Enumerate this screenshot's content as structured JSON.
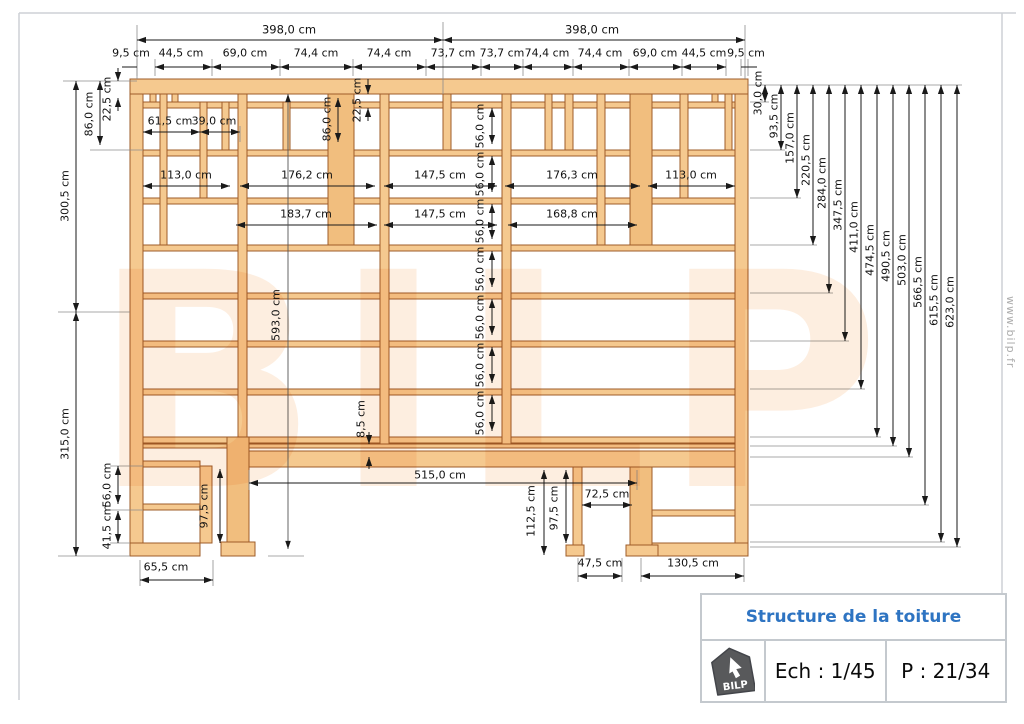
{
  "title_block": {
    "title": "Structure de la toiture",
    "logo_text": "BILP",
    "scale": "Ech : 1/45",
    "page_num": "P : 21/34"
  },
  "watermarks": {
    "side_text": "www.bilp.fr",
    "background_text": "BILP"
  },
  "colors": {
    "wood_fill": "#F5C98F",
    "wood_stroke": "#9E5C28",
    "title_blue": "#2E74C2",
    "logo_gray": "#58595B",
    "border_gray": "#C4C9CE"
  },
  "dim_labels": {
    "top": [
      {
        "t": "398,0 cm",
        "x": 289,
        "y": 30,
        "big": 1
      },
      {
        "t": "398,0 cm",
        "x": 592,
        "y": 30,
        "big": 1
      },
      {
        "t": "9,5 cm",
        "x": 131,
        "y": 53
      },
      {
        "t": "44,5 cm",
        "x": 181,
        "y": 53
      },
      {
        "t": "69,0 cm",
        "x": 245,
        "y": 53
      },
      {
        "t": "74,4 cm",
        "x": 316,
        "y": 53
      },
      {
        "t": "74,4 cm",
        "x": 389,
        "y": 53
      },
      {
        "t": "73,7 cm",
        "x": 453,
        "y": 53
      },
      {
        "t": "73,7 cm",
        "x": 502,
        "y": 53
      },
      {
        "t": "74,4 cm",
        "x": 547,
        "y": 53
      },
      {
        "t": "74,4 cm",
        "x": 600,
        "y": 53
      },
      {
        "t": "69,0 cm",
        "x": 655,
        "y": 53
      },
      {
        "t": "44,5 cm",
        "x": 704,
        "y": 53
      },
      {
        "t": "9,5 cm",
        "x": 746,
        "y": 53
      }
    ],
    "left": [
      {
        "t": "22,5 cm",
        "x": 107,
        "y": 99,
        "r": 1
      },
      {
        "t": "86,0 cm",
        "x": 89,
        "y": 114,
        "r": 1
      },
      {
        "t": "300,5 cm",
        "x": 65,
        "y": 196,
        "r": 1
      },
      {
        "t": "315,0 cm",
        "x": 65,
        "y": 434,
        "r": 1
      },
      {
        "t": "56,0 cm",
        "x": 107,
        "y": 485,
        "r": 1
      },
      {
        "t": "41,5 cm",
        "x": 107,
        "y": 527,
        "r": 1
      }
    ],
    "right": [
      {
        "t": "30,0 cm",
        "x": 758,
        "y": 93,
        "r": 1
      },
      {
        "t": "93,5 cm",
        "x": 774,
        "y": 116,
        "r": 1
      },
      {
        "t": "157,0 cm",
        "x": 790,
        "y": 138,
        "r": 1
      },
      {
        "t": "220,5 cm",
        "x": 806,
        "y": 160,
        "r": 1
      },
      {
        "t": "284,0 cm",
        "x": 822,
        "y": 183,
        "r": 1
      },
      {
        "t": "347,5 cm",
        "x": 838,
        "y": 205,
        "r": 1
      },
      {
        "t": "411,0 cm",
        "x": 854,
        "y": 227,
        "r": 1
      },
      {
        "t": "474,5 cm",
        "x": 870,
        "y": 250,
        "r": 1
      },
      {
        "t": "490,5 cm",
        "x": 886,
        "y": 256,
        "r": 1
      },
      {
        "t": "503,0 cm",
        "x": 902,
        "y": 260,
        "r": 1
      },
      {
        "t": "566,5 cm",
        "x": 918,
        "y": 282,
        "r": 1
      },
      {
        "t": "615,5 cm",
        "x": 934,
        "y": 300,
        "r": 1
      },
      {
        "t": "623,0 cm",
        "x": 950,
        "y": 302,
        "r": 1
      }
    ],
    "interior": [
      {
        "t": "61,5 cm",
        "x": 170,
        "y": 121
      },
      {
        "t": "39,0 cm",
        "x": 214,
        "y": 121
      },
      {
        "t": "113,0 cm",
        "x": 186,
        "y": 175
      },
      {
        "t": "176,2 cm",
        "x": 307,
        "y": 175
      },
      {
        "t": "147,5 cm",
        "x": 440,
        "y": 175
      },
      {
        "t": "176,3 cm",
        "x": 572,
        "y": 175
      },
      {
        "t": "113,0 cm",
        "x": 691,
        "y": 175
      },
      {
        "t": "183,7 cm",
        "x": 306,
        "y": 214
      },
      {
        "t": "147,5 cm",
        "x": 440,
        "y": 214
      },
      {
        "t": "168,8 cm",
        "x": 572,
        "y": 214
      },
      {
        "t": "86,0 cm",
        "x": 327,
        "y": 119,
        "r": 1
      },
      {
        "t": "22,5 cm",
        "x": 357,
        "y": 100,
        "r": 1
      },
      {
        "t": "56,0 cm",
        "x": 480,
        "y": 126,
        "r": 1
      },
      {
        "t": "56,0 cm",
        "x": 480,
        "y": 174,
        "r": 1
      },
      {
        "t": "56,0 cm",
        "x": 480,
        "y": 221,
        "r": 1
      },
      {
        "t": "56,0 cm",
        "x": 480,
        "y": 269,
        "r": 1
      },
      {
        "t": "56,0 cm",
        "x": 480,
        "y": 317,
        "r": 1
      },
      {
        "t": "56,0 cm",
        "x": 480,
        "y": 365,
        "r": 1
      },
      {
        "t": "56,0 cm",
        "x": 480,
        "y": 413,
        "r": 1
      },
      {
        "t": "593,0 cm",
        "x": 276,
        "y": 315,
        "r": 1
      },
      {
        "t": "8,5 cm",
        "x": 361,
        "y": 419,
        "r": 1
      },
      {
        "t": "515,0 cm",
        "x": 440,
        "y": 475
      },
      {
        "t": "112,5 cm",
        "x": 531,
        "y": 511,
        "r": 1
      },
      {
        "t": "97,5 cm",
        "x": 554,
        "y": 508,
        "r": 1
      },
      {
        "t": "97,5 cm",
        "x": 204,
        "y": 506,
        "r": 1
      },
      {
        "t": "72,5 cm",
        "x": 607,
        "y": 494
      }
    ],
    "bottom": [
      {
        "t": "65,5 cm",
        "x": 166,
        "y": 567
      },
      {
        "t": "47,5 cm",
        "x": 600,
        "y": 563
      },
      {
        "t": "130,5 cm",
        "x": 693,
        "y": 563
      }
    ]
  }
}
